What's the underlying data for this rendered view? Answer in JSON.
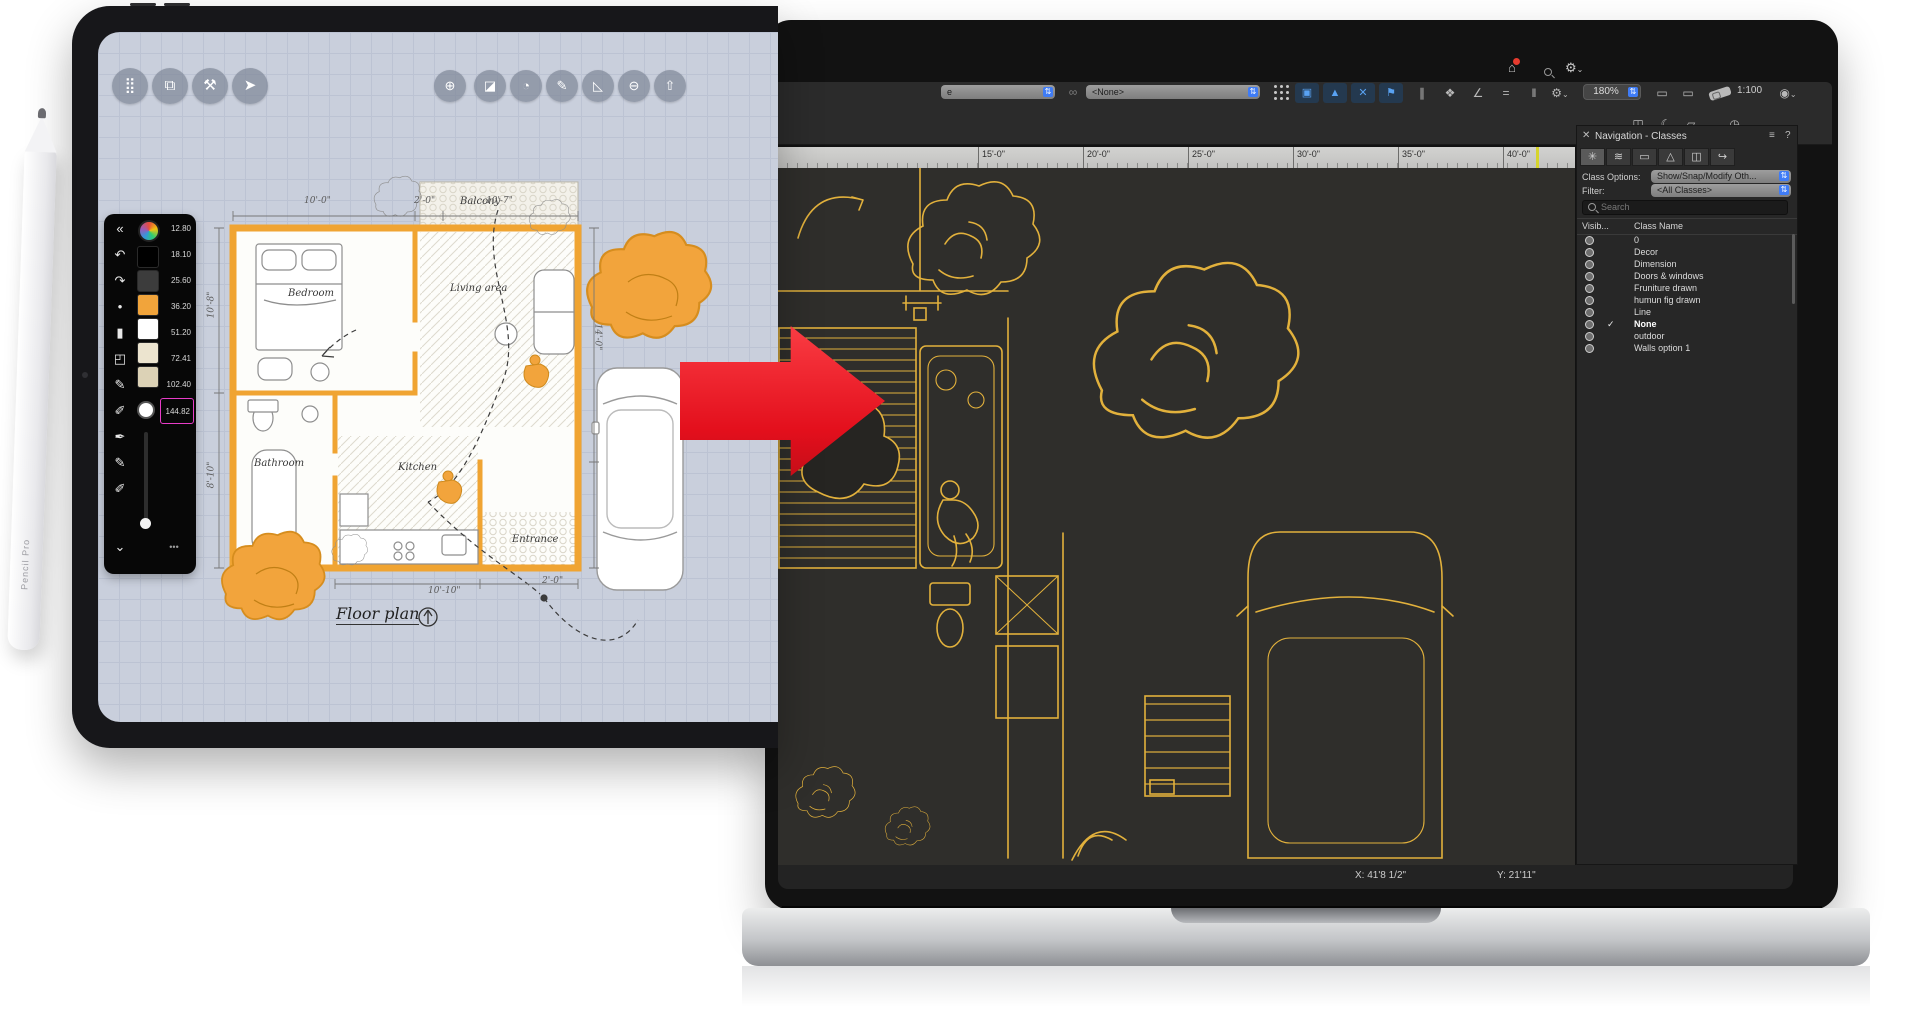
{
  "colors": {
    "accent_orange": "#f2a43c",
    "cad_yellow": "#e2b13c",
    "arrow_red": "#e30f1c",
    "highlight_magenta": "#e83cc8",
    "mac_blue": "#3f7cf6"
  },
  "pencil": {
    "label": "Pencil Pro"
  },
  "ipad": {
    "palette": {
      "sizes": [
        "12.80",
        "18.10",
        "25.60",
        "36.20",
        "51.20",
        "72.41",
        "102.40",
        "144.82"
      ],
      "active_size": "144.82"
    },
    "plan": {
      "title": "Floor plan",
      "rooms": [
        "Bedroom",
        "Living area",
        "Balcony",
        "Bathroom",
        "Kitchen",
        "Entrance"
      ],
      "dims": [
        "10'-0\"",
        "2'-0\"",
        "10'-7\"",
        "10'-8\"",
        "8'-10\"",
        "14'-0\"",
        "10'-10\"",
        "2'-0\""
      ]
    }
  },
  "mac": {
    "toolbar": {
      "partial_value": "e",
      "none_value": "<None>",
      "zoom_value": "180%",
      "scale_value": "1:100"
    },
    "ruler": {
      "ticks": [
        "15'-0\"",
        "20'-0\"",
        "25'-0\"",
        "30'-0\"",
        "35'-0\"",
        "40'-0\""
      ]
    },
    "panel": {
      "title": "Navigation - Classes",
      "class_options_label": "Class Options:",
      "class_options_value": "Show/Snap/Modify Oth...",
      "filter_label": "Filter:",
      "filter_value": "<All Classes>",
      "search_placeholder": "Search",
      "columns": {
        "visibility": "Visib...",
        "class_name": "Class Name"
      },
      "classes": [
        "0",
        "Decor",
        "Dimension",
        "Doors & windows",
        "Fruniture drawn",
        "humun fig drawn",
        "Line",
        "None",
        "outdoor",
        "Walls option 1"
      ],
      "active_class": "None"
    },
    "status": {
      "x": "X: 41'8 1/2\"",
      "y": "Y: 21'11\""
    }
  },
  "glyphs": {
    "collapse": "«",
    "undo": "↶",
    "redo": "↷",
    "dot": "•",
    "chevron_down": "⌄",
    "more": "•••",
    "grid": "⣿",
    "duplicate": "⧉",
    "tools": "⚒",
    "dart": "➤",
    "precision": "⊕",
    "mask": "◪",
    "protractor": "◔",
    "pen": "✎",
    "pen2": "✐",
    "ink": "✒",
    "marker": "▮",
    "eraser": "◰",
    "triangle_tool": "◺",
    "minus": "⊖",
    "share": "⇧",
    "home": "⌂",
    "gear": "⚙",
    "chev": "⌄",
    "pause": "‖",
    "close": "✕",
    "menu": "≡",
    "help": "?",
    "check": "✓",
    "link": "∞",
    "sel": "▣",
    "tri": "▲",
    "x": "✕",
    "flag": "⚑",
    "slashes": "∥",
    "paint": "❖",
    "angle": "∠",
    "dashes": "=",
    "frame": "▭",
    "eye": "◉",
    "cube": "◫",
    "leaf": "☾",
    "crop": "▱",
    "clock": "◷",
    "updown": "⇅",
    "tab1": "✳",
    "tab2": "≋",
    "tab3": "▭",
    "tab4": "△",
    "tab5": "◫",
    "tab6": "↪"
  }
}
